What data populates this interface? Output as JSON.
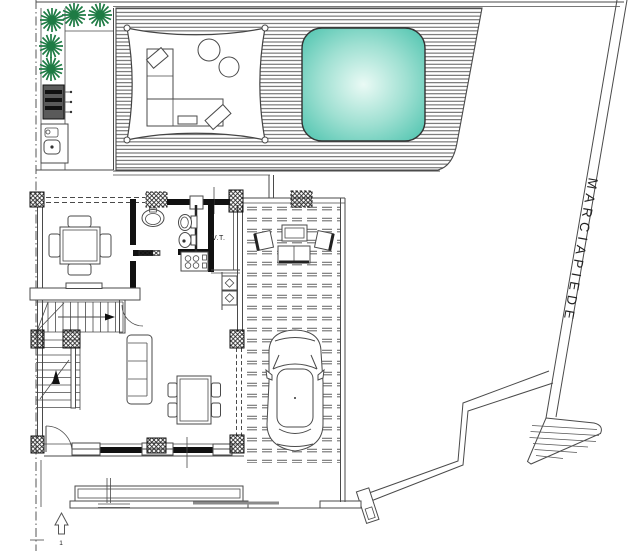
{
  "drawing": {
    "labels": {
      "sidewalk": "MARCIAPIEDE",
      "technical_room": "V.T.",
      "entry_marker": "1"
    },
    "colors": {
      "line": "#4a4a4a",
      "wall": "#111111",
      "tree_green": "#1e7b44",
      "pool_edge": "#58c7b3",
      "pool_mid": "#9fe0d2",
      "pool_center": "#eafaf5",
      "equipment_gray": "#5a5a5a",
      "paving_gray": "#6e6e6e"
    }
  }
}
